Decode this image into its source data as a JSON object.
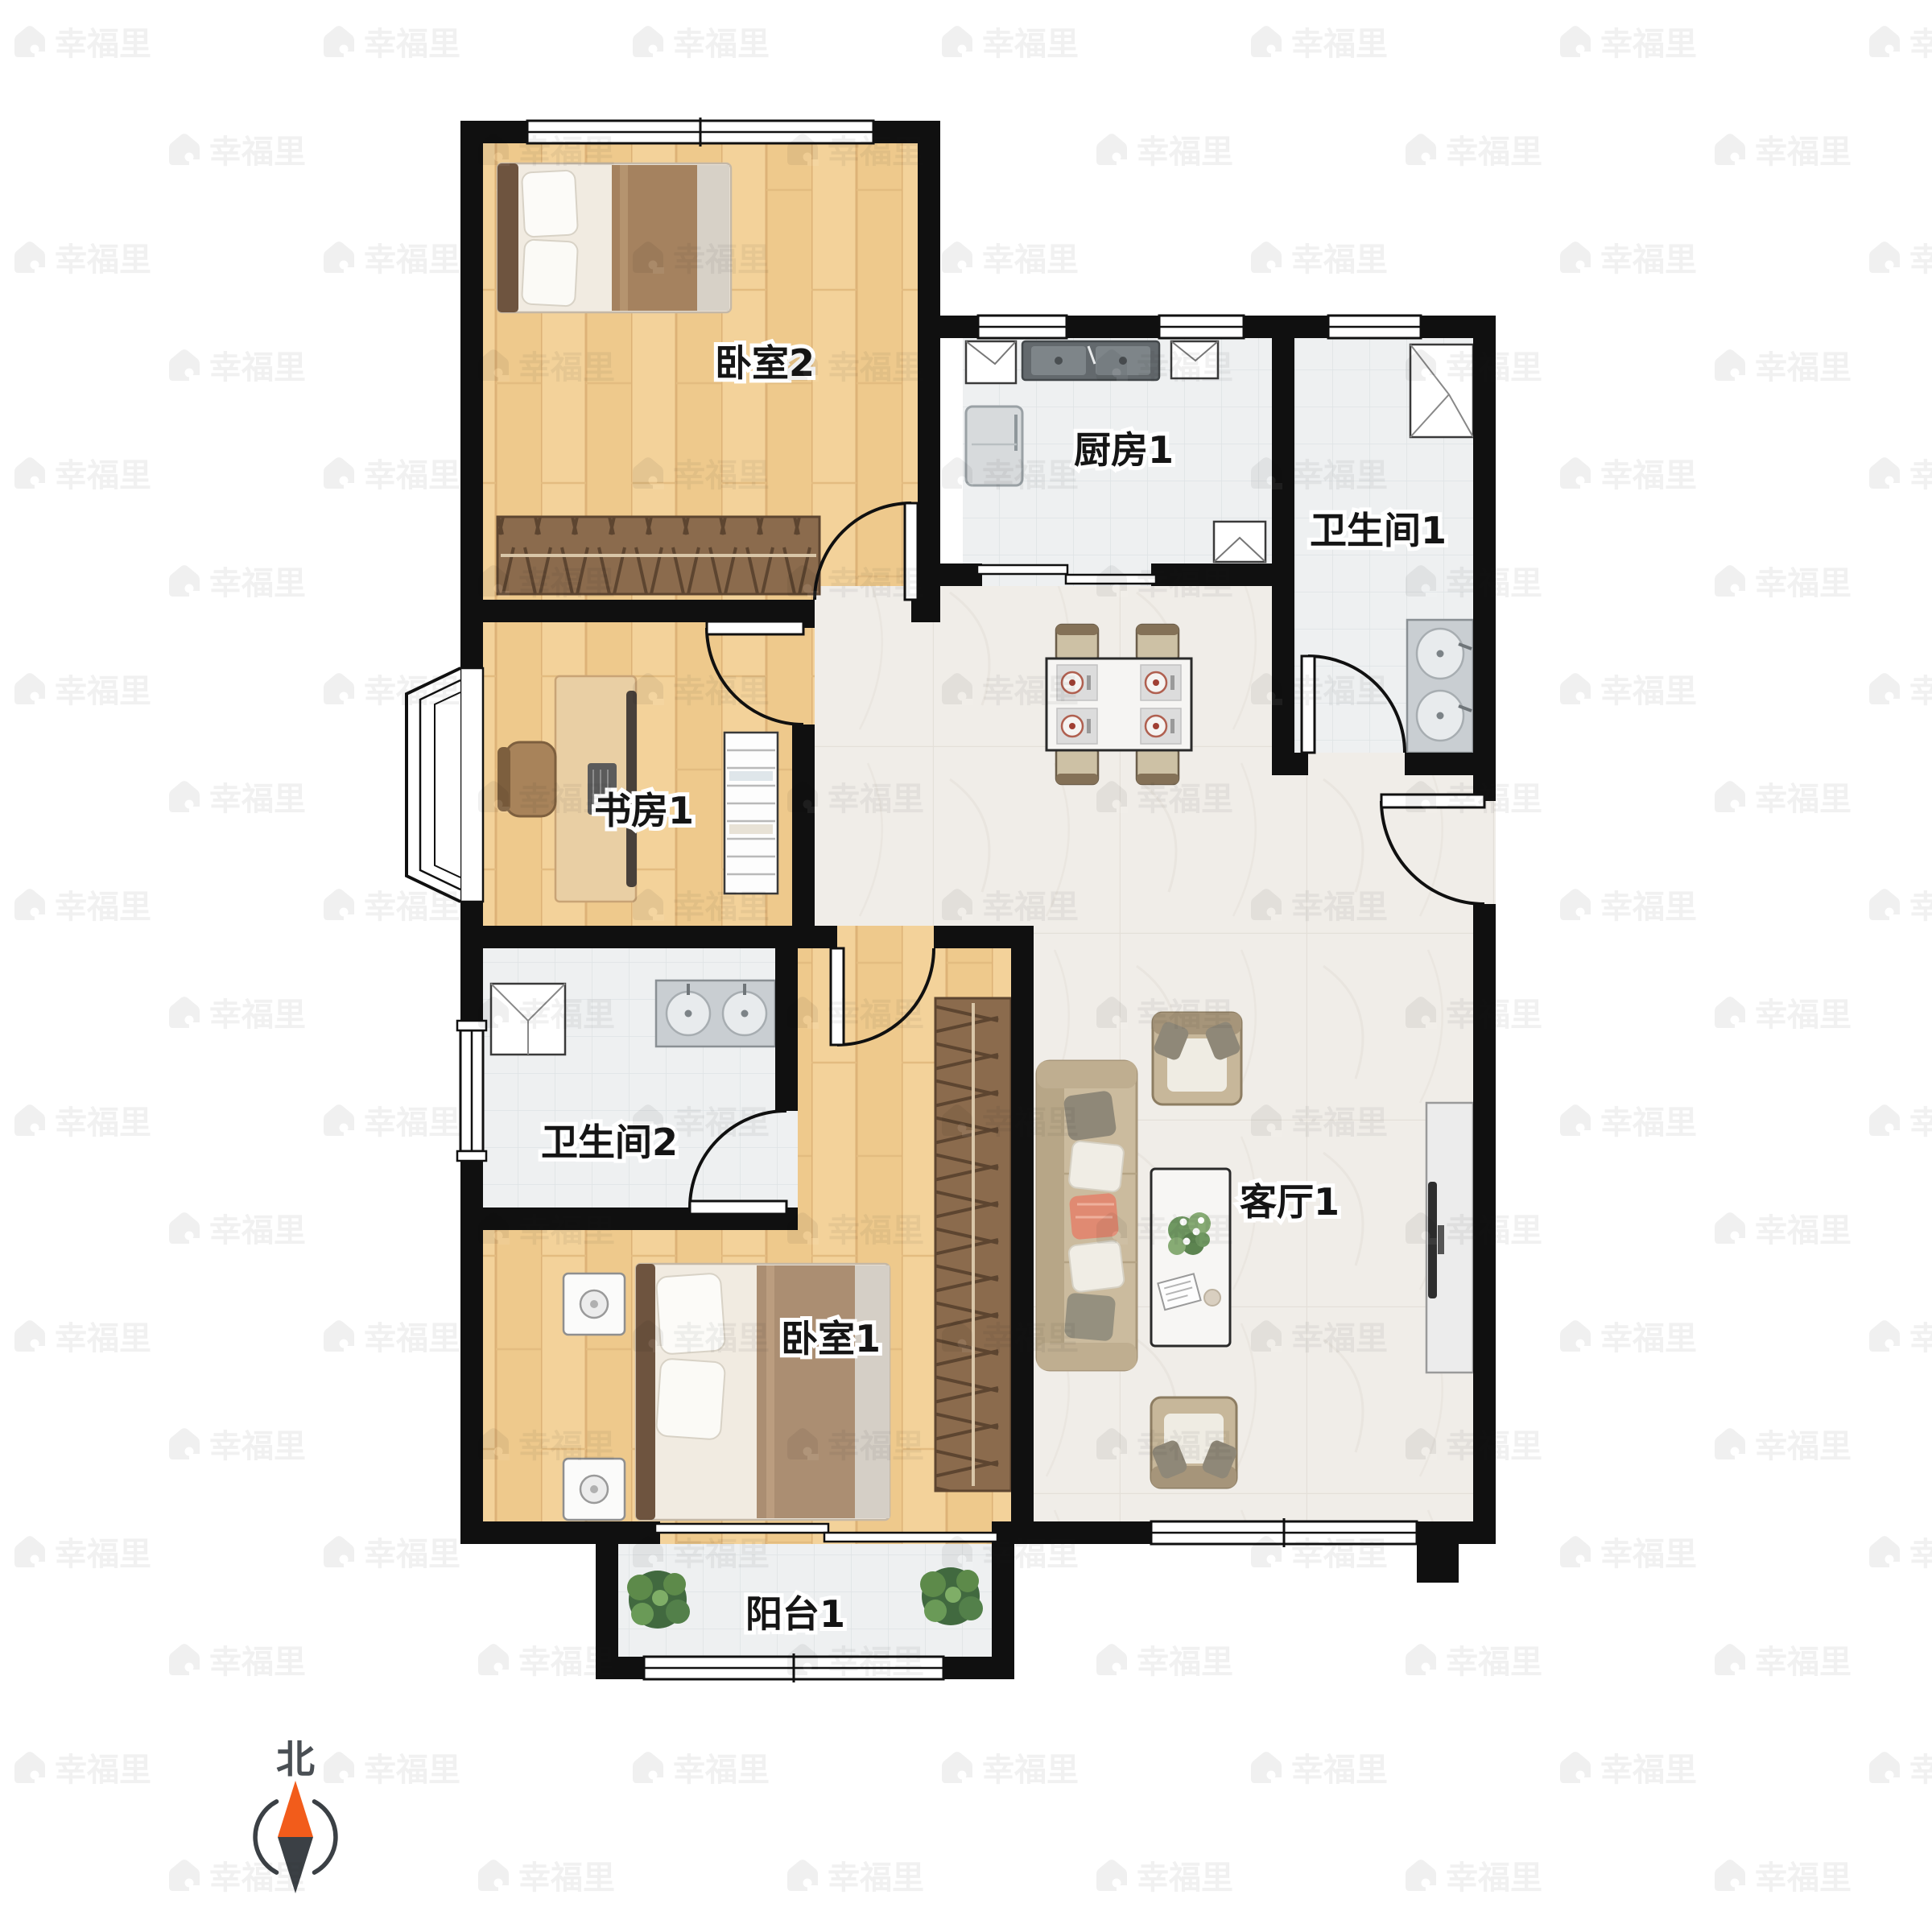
{
  "floor_plan": {
    "type": "apartment-floor-plan",
    "rooms": [
      {
        "name": "bedroom-2",
        "label": "卧室2"
      },
      {
        "name": "kitchen-1",
        "label": "厨房1"
      },
      {
        "name": "bathroom-1",
        "label": "卫生间1"
      },
      {
        "name": "study-1",
        "label": "书房1"
      },
      {
        "name": "bathroom-2",
        "label": "卫生间2"
      },
      {
        "name": "bedroom-1",
        "label": "卧室1"
      },
      {
        "name": "living-room-1",
        "label": "客厅1"
      },
      {
        "name": "balcony-1",
        "label": "阳台1"
      }
    ]
  },
  "compass": {
    "north_label": "北",
    "needle_north_color": "#f25c1b",
    "needle_south_color": "#3b4045",
    "ring_color": "#3b4045"
  },
  "watermark": {
    "brand_text": "幸福里",
    "color": "#1a1a1a",
    "opacity": "0.06"
  },
  "palette": {
    "wall": "#101010",
    "wood_floor": "#f2cf96",
    "wood_plank_line": "#ddb277",
    "tile_floor": "#eef0f1",
    "tile_grid": "#dfe3e5",
    "marble_floor": "#f0ede8",
    "marble_grid": "#e4e0d9",
    "wardrobe_brown": "#8b6b4d",
    "bed_blanket": "#a98a68",
    "sofa_tan": "#cbbb9e",
    "accent_pillow": "#e08a72"
  }
}
